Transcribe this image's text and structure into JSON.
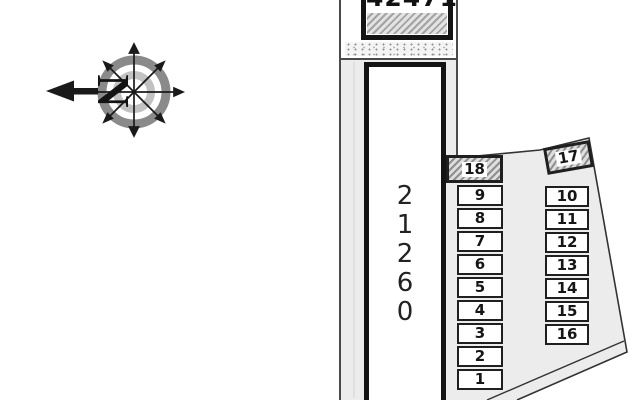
{
  "compass": {
    "north_label": "N"
  },
  "buildings": {
    "upper": {
      "number": "42471"
    },
    "main": {
      "number": "21260",
      "stacked": "2\n1\n2\n6\n0"
    }
  },
  "parking": {
    "left_column": [
      "18",
      "9",
      "8",
      "7",
      "6",
      "5",
      "4",
      "3",
      "2",
      "1"
    ],
    "right_column": [
      "17",
      "10",
      "11",
      "12",
      "13",
      "14",
      "15",
      "16"
    ]
  },
  "colors": {
    "ground": "#ececec",
    "outline": "#333333",
    "building_border": "#141414",
    "compass_ring_outer": "#8a8a8a",
    "compass_ring_inner": "#c2c2c2",
    "hatch_stripe": "#8f8f8f",
    "hatch_bg": "#dedede"
  }
}
